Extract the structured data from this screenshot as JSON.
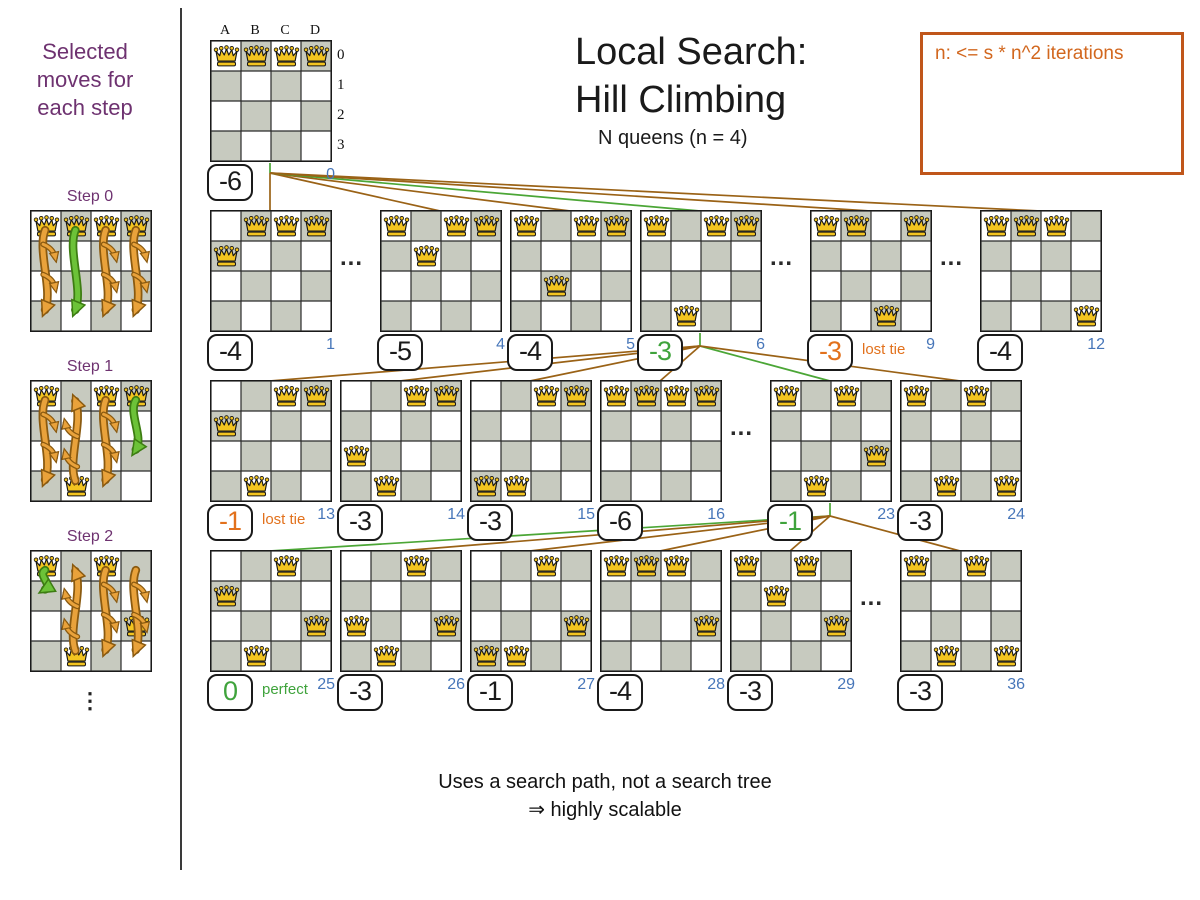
{
  "sidebar": {
    "title": "Selected moves for each step",
    "ellipsis": "⋮",
    "steps": [
      {
        "label": "Step 0",
        "queens": [
          0,
          0,
          0,
          0
        ],
        "arrows": [
          {
            "col": 0,
            "from": 0,
            "to": 3,
            "color": "orange"
          },
          {
            "col": 1,
            "from": 0,
            "to": 3,
            "color": "green"
          },
          {
            "col": 2,
            "from": 0,
            "to": 3,
            "color": "orange"
          },
          {
            "col": 3,
            "from": 0,
            "to": 3,
            "color": "orange"
          }
        ]
      },
      {
        "label": "Step 1",
        "queens": [
          0,
          3,
          0,
          0
        ],
        "arrows": [
          {
            "col": 0,
            "from": 0,
            "to": 3,
            "color": "orange"
          },
          {
            "col": 1,
            "from": 3,
            "to": 0,
            "color": "orange"
          },
          {
            "col": 2,
            "from": 0,
            "to": 3,
            "color": "orange"
          },
          {
            "col": 3,
            "from": 0,
            "to": 2,
            "color": "green"
          }
        ]
      },
      {
        "label": "Step 2",
        "queens": [
          0,
          3,
          0,
          2
        ],
        "arrows": [
          {
            "col": 0,
            "from": 0,
            "to": 1,
            "color": "green"
          },
          {
            "col": 1,
            "from": 3,
            "to": 0,
            "color": "orange"
          },
          {
            "col": 2,
            "from": 0,
            "to": 3,
            "color": "orange"
          },
          {
            "col": 3,
            "from": 0,
            "to": 3,
            "color": "orange"
          }
        ]
      }
    ]
  },
  "header": {
    "title_line1": "Local Search:",
    "title_line2": "Hill Climbing",
    "subtitle": "N queens (n = 4)"
  },
  "note": {
    "text": "n: <= s * n^2 iterations"
  },
  "board_labels": {
    "cols": [
      "A",
      "B",
      "C",
      "D"
    ],
    "rows": [
      "0",
      "1",
      "2",
      "3"
    ]
  },
  "root_board": {
    "index": "0",
    "score": "-6",
    "style": "normal",
    "queens": [
      0,
      0,
      0,
      0
    ]
  },
  "dots": "...",
  "tree_rows": [
    {
      "boards": [
        {
          "index": "1",
          "score": "-4",
          "style": "normal",
          "queens": [
            1,
            0,
            0,
            0
          ]
        },
        {
          "index": "4",
          "score": "-5",
          "style": "normal",
          "queens": [
            0,
            1,
            0,
            0
          ]
        },
        {
          "index": "5",
          "score": "-4",
          "style": "normal",
          "queens": [
            0,
            2,
            0,
            0
          ]
        },
        {
          "index": "6",
          "score": "-3",
          "style": "selected",
          "queens": [
            0,
            3,
            0,
            0
          ]
        },
        {
          "index": "9",
          "score": "-3",
          "style": "lost",
          "tag": "lost tie",
          "queens": [
            0,
            0,
            3,
            0
          ]
        },
        {
          "index": "12",
          "score": "-4",
          "style": "normal",
          "queens": [
            0,
            0,
            0,
            3
          ]
        }
      ]
    },
    {
      "boards": [
        {
          "index": "13",
          "score": "-1",
          "style": "lost",
          "tag": "lost tie",
          "queens": [
            1,
            3,
            0,
            0
          ]
        },
        {
          "index": "14",
          "score": "-3",
          "style": "normal",
          "queens": [
            2,
            3,
            0,
            0
          ]
        },
        {
          "index": "15",
          "score": "-3",
          "style": "normal",
          "queens": [
            3,
            3,
            0,
            0
          ]
        },
        {
          "index": "16",
          "score": "-6",
          "style": "normal",
          "queens": [
            0,
            0,
            0,
            0
          ]
        },
        {
          "index": "23",
          "score": "-1",
          "style": "selected",
          "queens": [
            0,
            3,
            0,
            2
          ]
        },
        {
          "index": "24",
          "score": "-3",
          "style": "normal",
          "queens": [
            0,
            3,
            0,
            3
          ]
        }
      ]
    },
    {
      "boards": [
        {
          "index": "25",
          "score": "0",
          "style": "selected",
          "tag": "perfect",
          "queens": [
            1,
            3,
            0,
            2
          ]
        },
        {
          "index": "26",
          "score": "-3",
          "style": "normal",
          "queens": [
            2,
            3,
            0,
            2
          ]
        },
        {
          "index": "27",
          "score": "-1",
          "style": "normal",
          "queens": [
            3,
            3,
            0,
            2
          ]
        },
        {
          "index": "28",
          "score": "-4",
          "style": "normal",
          "queens": [
            0,
            0,
            0,
            2
          ]
        },
        {
          "index": "29",
          "score": "-3",
          "style": "normal",
          "queens": [
            0,
            1,
            0,
            2
          ]
        },
        {
          "index": "36",
          "score": "-3",
          "style": "normal",
          "queens": [
            0,
            3,
            0,
            3
          ]
        }
      ]
    }
  ],
  "footer": {
    "line1": "Uses a search path, not a search tree",
    "line2": "⇒ highly scalable"
  },
  "colors": {
    "selected_green": "#3fa33c",
    "lost_orange": "#e2711c",
    "index_blue": "#4776b9",
    "line_brown": "#9a6216",
    "line_green": "#4ba636",
    "note_orange": "#d2671e",
    "sidebar_purple": "#6e3270",
    "board_gray": "#c7cabf",
    "queen_gold": "#f4c520"
  }
}
